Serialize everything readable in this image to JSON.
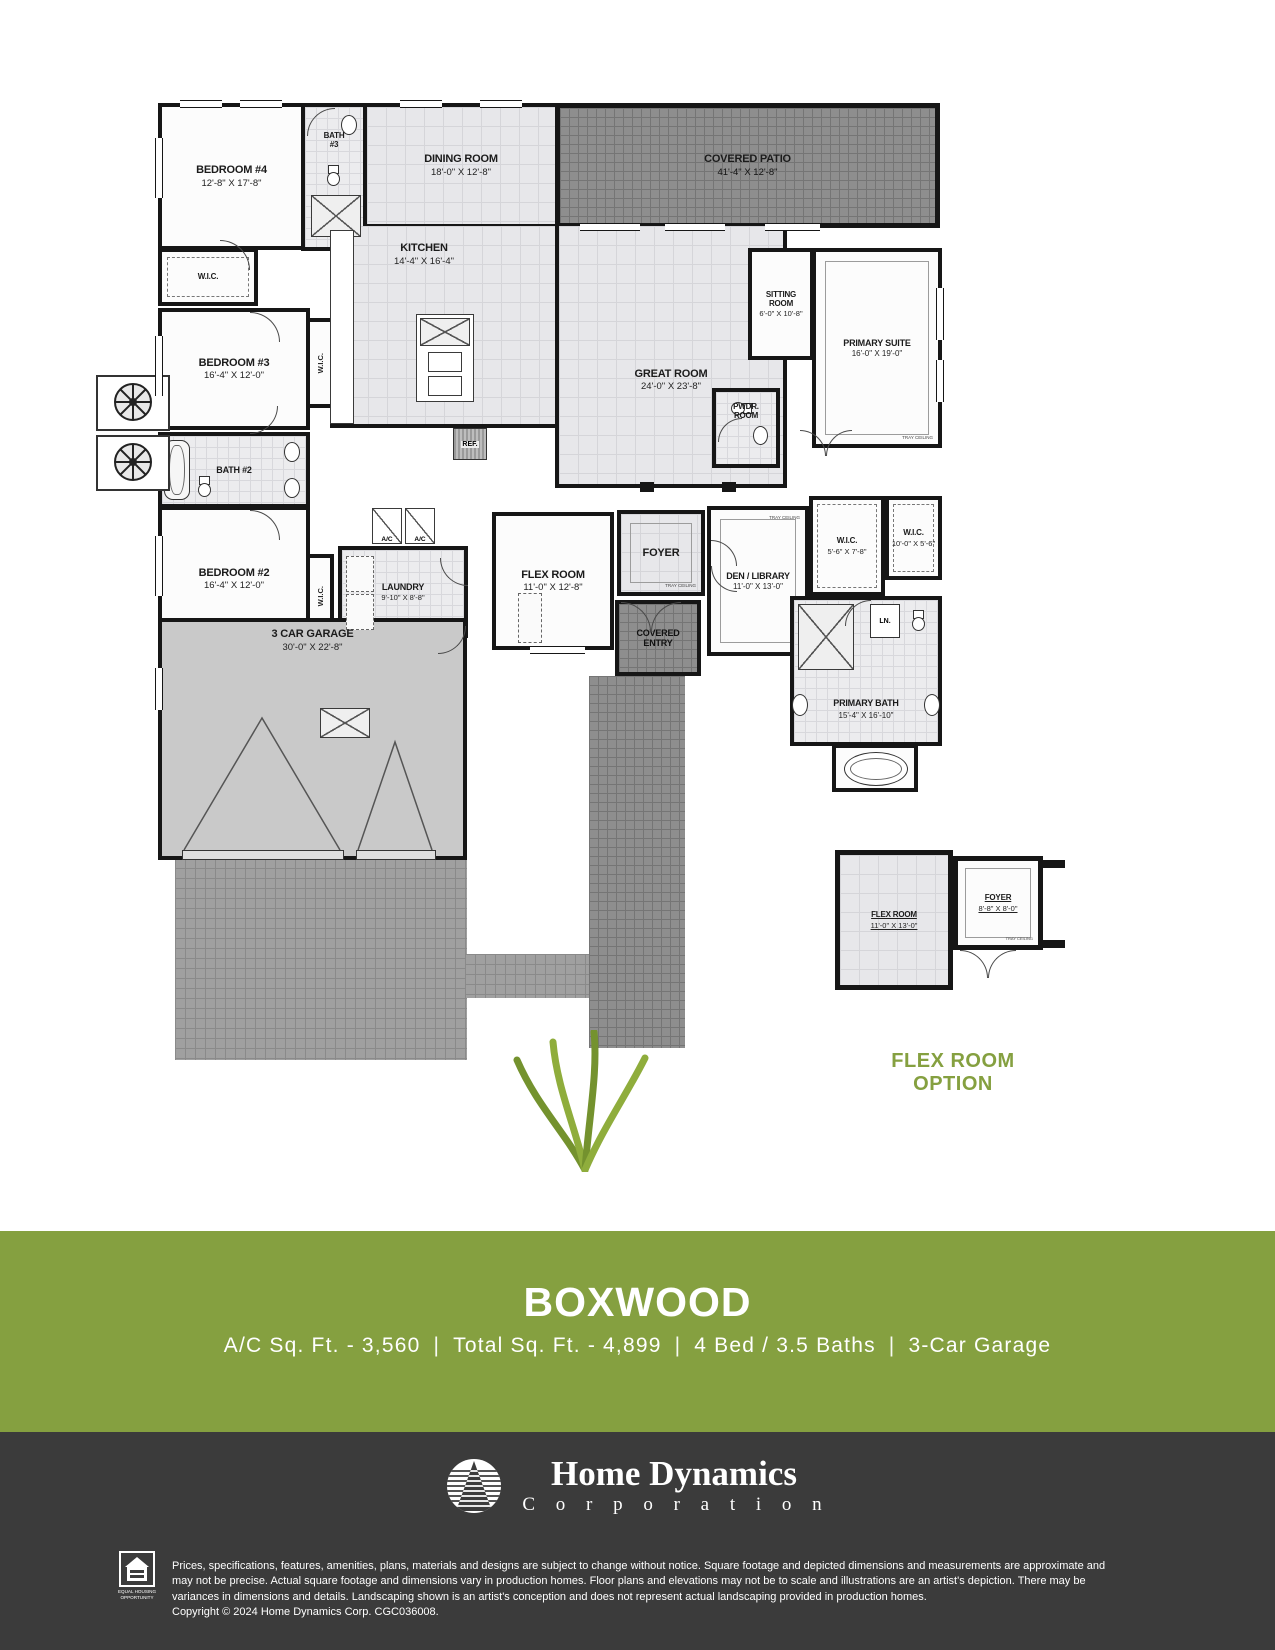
{
  "plan": {
    "rooms": {
      "covered_patio": {
        "name": "COVERED PATIO",
        "dims": "41'-4\" X 12'-8\""
      },
      "bedroom4": {
        "name": "BEDROOM #4",
        "dims": "12'-8\" X 17'-8\""
      },
      "bath3": {
        "line1": "BATH",
        "line2": "#3"
      },
      "dining": {
        "name": "DINING ROOM",
        "dims": "18'-0\" X 12'-8\""
      },
      "wic": {
        "name": "W.I.C."
      },
      "kitchen": {
        "name": "KITCHEN",
        "dims": "14'-4\" X 16'-4\""
      },
      "sitting": {
        "line1": "SITTING",
        "line2": "ROOM",
        "dims": "6'-0\" X 10'-8\""
      },
      "primary_suite": {
        "name": "PRIMARY SUITE",
        "dims": "16'-0\" X 19'-0\"",
        "note": "TRAY CEILING"
      },
      "bedroom3": {
        "name": "BEDROOM #3",
        "dims": "16'-4\" X 12'-0\""
      },
      "great_room": {
        "name": "GREAT ROOM",
        "dims": "24'-0\" X 23'-8\""
      },
      "pwdr": {
        "line1": "PWDR.",
        "line2": "ROOM"
      },
      "ref": {
        "name": "REF."
      },
      "bath2": {
        "name": "BATH #2"
      },
      "bedroom2": {
        "name": "BEDROOM #2",
        "dims": "16'-4\" X 12'-0\""
      },
      "laundry": {
        "name": "LAUNDRY",
        "dims": "9'-10\" X 8'-8\""
      },
      "ac": {
        "name": "A/C"
      },
      "flex": {
        "name": "FLEX ROOM",
        "dims": "11'-0\" X 12'-8\""
      },
      "foyer": {
        "name": "FOYER",
        "note": "TRAY CEILING"
      },
      "den": {
        "name": "DEN / LIBRARY",
        "dims": "11'-0\" X 13'-0\"",
        "note": "TRAY CEILING"
      },
      "wic_primary1": {
        "name": "W.I.C.",
        "dims": "5'-6\" X 7'-8\""
      },
      "wic_primary2": {
        "name": "W.I.C.",
        "dims": "10'-0\" X 5'-6\""
      },
      "linen": {
        "name": "LN."
      },
      "primary_bath": {
        "name": "PRIMARY BATH",
        "dims": "15'-4\" X 16'-10\""
      },
      "covered_entry": {
        "line1": "COVERED",
        "line2": "ENTRY"
      },
      "garage": {
        "name": "3 CAR GARAGE",
        "dims": "30'-0\" X 22'-8\""
      }
    },
    "inset": {
      "flex": {
        "name": "FLEX ROOM",
        "dims": "11'-0\" X 13'-0\""
      },
      "foyer": {
        "name": "FOYER",
        "dims": "8'-8\" X 8'-0\"",
        "note": "TRAY CEILING"
      },
      "caption_line1": "FLEX ROOM",
      "caption_line2": "OPTION"
    }
  },
  "banner": {
    "title": "BOXWOOD",
    "separator": "|",
    "stats": [
      {
        "label": "A/C Sq. Ft. - 3,560"
      },
      {
        "label": "Total Sq. Ft. - 4,899"
      },
      {
        "label": "4 Bed / 3.5 Baths"
      },
      {
        "label": "3-Car Garage"
      }
    ]
  },
  "footer": {
    "company_name": "Home Dynamics",
    "company_sub": "C o r p o r a t i o n",
    "eh_line1": "EQUAL HOUSING",
    "eh_line2": "OPPORTUNITY",
    "disclaimer": "Prices, specifications, features, amenities, plans, materials and designs are subject to change without notice. Square footage and depicted dimensions and measurements are approximate and may not be precise. Actual square footage and dimensions vary in production homes. Floor plans and elevations may not be to scale and illustrations are an artist's depiction.  There may be variances in dimensions and details. Landscaping shown is an artist's conception and does not represent actual landscaping provided in production homes.",
    "copyright": "Copyright © 2024 Home Dynamics Corp. CGC036008."
  },
  "colors": {
    "accent_green": "#85A040",
    "band_charcoal": "#3B3B3B",
    "wall_black": "#161616"
  }
}
